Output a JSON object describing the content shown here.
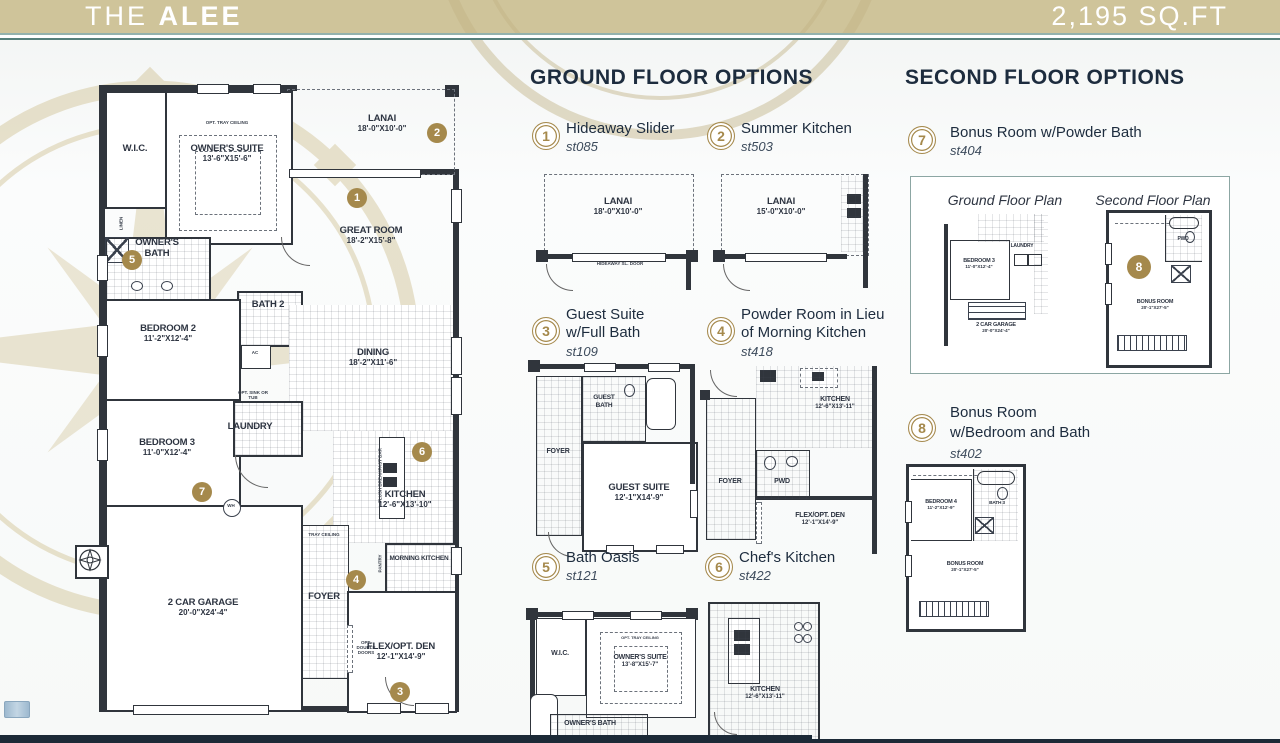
{
  "header": {
    "title_prefix": "THE",
    "title_name": "ALEE",
    "sqft": "2,195 SQ.FT"
  },
  "plan": {
    "wic": "W.I.C.",
    "owners_suite": "OWNER'S SUITE",
    "owners_suite_dims": "13'-6\"X15'-6\"",
    "lanai": "LANAI",
    "lanai_dims": "18'-0\"X10'-0\"",
    "great_room": "GREAT ROOM",
    "great_room_dims": "18'-2\"X15'-8\"",
    "owners_bath": "OWNER'S BATH",
    "bath2": "BATH 2",
    "bedroom2": "BEDROOM 2",
    "bedroom2_dims": "11'-2\"X12'-4\"",
    "dining": "DINING",
    "dining_dims": "18'-2\"X11'-6\"",
    "bedroom3": "BEDROOM 3",
    "bedroom3_dims": "11'-0\"X12'-4\"",
    "laundry": "LAUNDRY",
    "kitchen": "KITCHEN",
    "kitchen_dims": "12'-6\"X13'-10\"",
    "morning_kitchen": "MORNING KITCHEN",
    "foyer": "FOYER",
    "flex_den": "FLEX/OPT. DEN",
    "flex_den_dims": "12'-1\"X14'-9\"",
    "garage": "2 CAR GARAGE",
    "garage_dims": "20'-0\"X24'-4\"",
    "notes": {
      "tray": "OPT. TRAY CEILING",
      "tray2": "TRAY CEILING",
      "pantry": "PANTRY",
      "ac": "AC",
      "linen": "LINEN",
      "wh": "WH",
      "opt_sink": "OPT. SINK OR TUB",
      "opt_doors": "OPT. DOUBLE DOORS",
      "bar": "FLUSH BREAKFAST BAR"
    },
    "markers": {
      "1": "1",
      "2": "2",
      "3": "3",
      "4": "4",
      "5": "5",
      "6": "6",
      "7": "7"
    }
  },
  "ground_options": {
    "title": "GROUND FLOOR OPTIONS",
    "items": [
      {
        "num": "1",
        "line1": "Hideaway Slider",
        "line2": "",
        "code": "st085"
      },
      {
        "num": "2",
        "line1": "Summer Kitchen",
        "line2": "",
        "code": "st503"
      },
      {
        "num": "3",
        "line1": "Guest Suite",
        "line2": "w/Full Bath",
        "code": "st109"
      },
      {
        "num": "4",
        "line1": "Powder Room in Lieu",
        "line2": "of Morning Kitchen",
        "code": "st418"
      },
      {
        "num": "5",
        "line1": "Bath Oasis",
        "line2": "",
        "code": "st121"
      },
      {
        "num": "6",
        "line1": "Chef's Kitchen",
        "line2": "",
        "code": "st422"
      }
    ],
    "diagrams": {
      "d1": {
        "lanai": "LANAI",
        "dims": "18'-0\"X10'-0\"",
        "note": "HIDEAWAY SL. DOOR"
      },
      "d2": {
        "lanai": "LANAI",
        "dims": "15'-0\"X10'-0\""
      },
      "d3": {
        "foyer": "FOYER",
        "guest_bath": "GUEST BATH",
        "suite": "GUEST SUITE",
        "suite_dims": "12'-1\"X14'-9\""
      },
      "d4": {
        "kitchen": "KITCHEN",
        "kitchen_dims": "12'-6\"X13'-11\"",
        "pwd": "PWD",
        "foyer": "FOYER",
        "den": "FLEX/OPT. DEN",
        "den_dims": "12'-1\"X14'-9\""
      },
      "d5": {
        "wic": "W.I.C.",
        "tray": "OPT. TRAY CEILING",
        "suite": "OWNER'S SUITE",
        "suite_dims": "13'-8\"X15'-7\"",
        "bath": "OWNER'S BATH"
      },
      "d6": {
        "kitchen": "KITCHEN",
        "dims": "12'-6\"X13'-11\""
      }
    }
  },
  "second_options": {
    "title": "SECOND FLOOR OPTIONS",
    "items": [
      {
        "num": "7",
        "line1": "Bonus Room w/Powder Bath",
        "line2": "",
        "code": "st404"
      },
      {
        "num": "8",
        "line1": "Bonus Room",
        "line2": "w/Bedroom and Bath",
        "code": "st402"
      }
    ],
    "inset": {
      "ground_title": "Ground Floor Plan",
      "second_title": "Second Floor Plan",
      "bedroom3": "BEDROOM 3",
      "bedroom3_dims": "11'-0\"X12'-4\"",
      "laundry": "LAUNDRY",
      "garage": "2 CAR GARAGE",
      "garage_dims": "20'-0\"X24'-4\"",
      "pwd": "PWD",
      "bonus": "BONUS ROOM",
      "bonus_dims": "20'-1\"X27'-5\"",
      "marker": "8"
    },
    "d8": {
      "bedroom4": "BEDROOM 4",
      "bedroom4_dims": "11'-2\"X12'-9\"",
      "bath3": "BATH 3",
      "bonus": "BONUS ROOM",
      "bonus_dims": "20'-1\"X27'-5\""
    }
  }
}
